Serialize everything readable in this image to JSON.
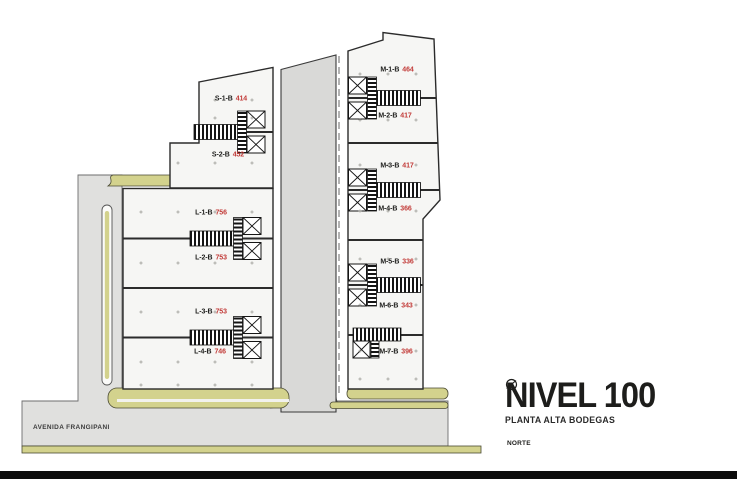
{
  "title_block": {
    "title": "NIVEL 100",
    "subtitle": "PLANTA ALTA BODEGAS",
    "north_label": "NORTE",
    "north_icon": "compass-north-arrow"
  },
  "street_label": "AVENIDA FRANGIPANI",
  "colors": {
    "ink": "#1d1d1b",
    "area_accent": "#c23b38",
    "building_fill": "#f6f6f4",
    "corridor_fill": "#d9d9d7",
    "road_fill": "#e0e0de",
    "olive": "#d3d28d"
  },
  "units": [
    {
      "id": "S-1-B",
      "area": "414"
    },
    {
      "id": "S-2-B",
      "area": "452"
    },
    {
      "id": "L-1-B",
      "area": "756"
    },
    {
      "id": "L-2-B",
      "area": "753"
    },
    {
      "id": "L-3-B",
      "area": "753"
    },
    {
      "id": "L-4-B",
      "area": "746"
    },
    {
      "id": "M-1-B",
      "area": "464"
    },
    {
      "id": "M-2-B",
      "area": "417"
    },
    {
      "id": "M-3-B",
      "area": "417"
    },
    {
      "id": "M-4-B",
      "area": "366"
    },
    {
      "id": "M-5-B",
      "area": "336"
    },
    {
      "id": "M-6-B",
      "area": "343"
    },
    {
      "id": "M-7-B",
      "area": "396"
    }
  ]
}
